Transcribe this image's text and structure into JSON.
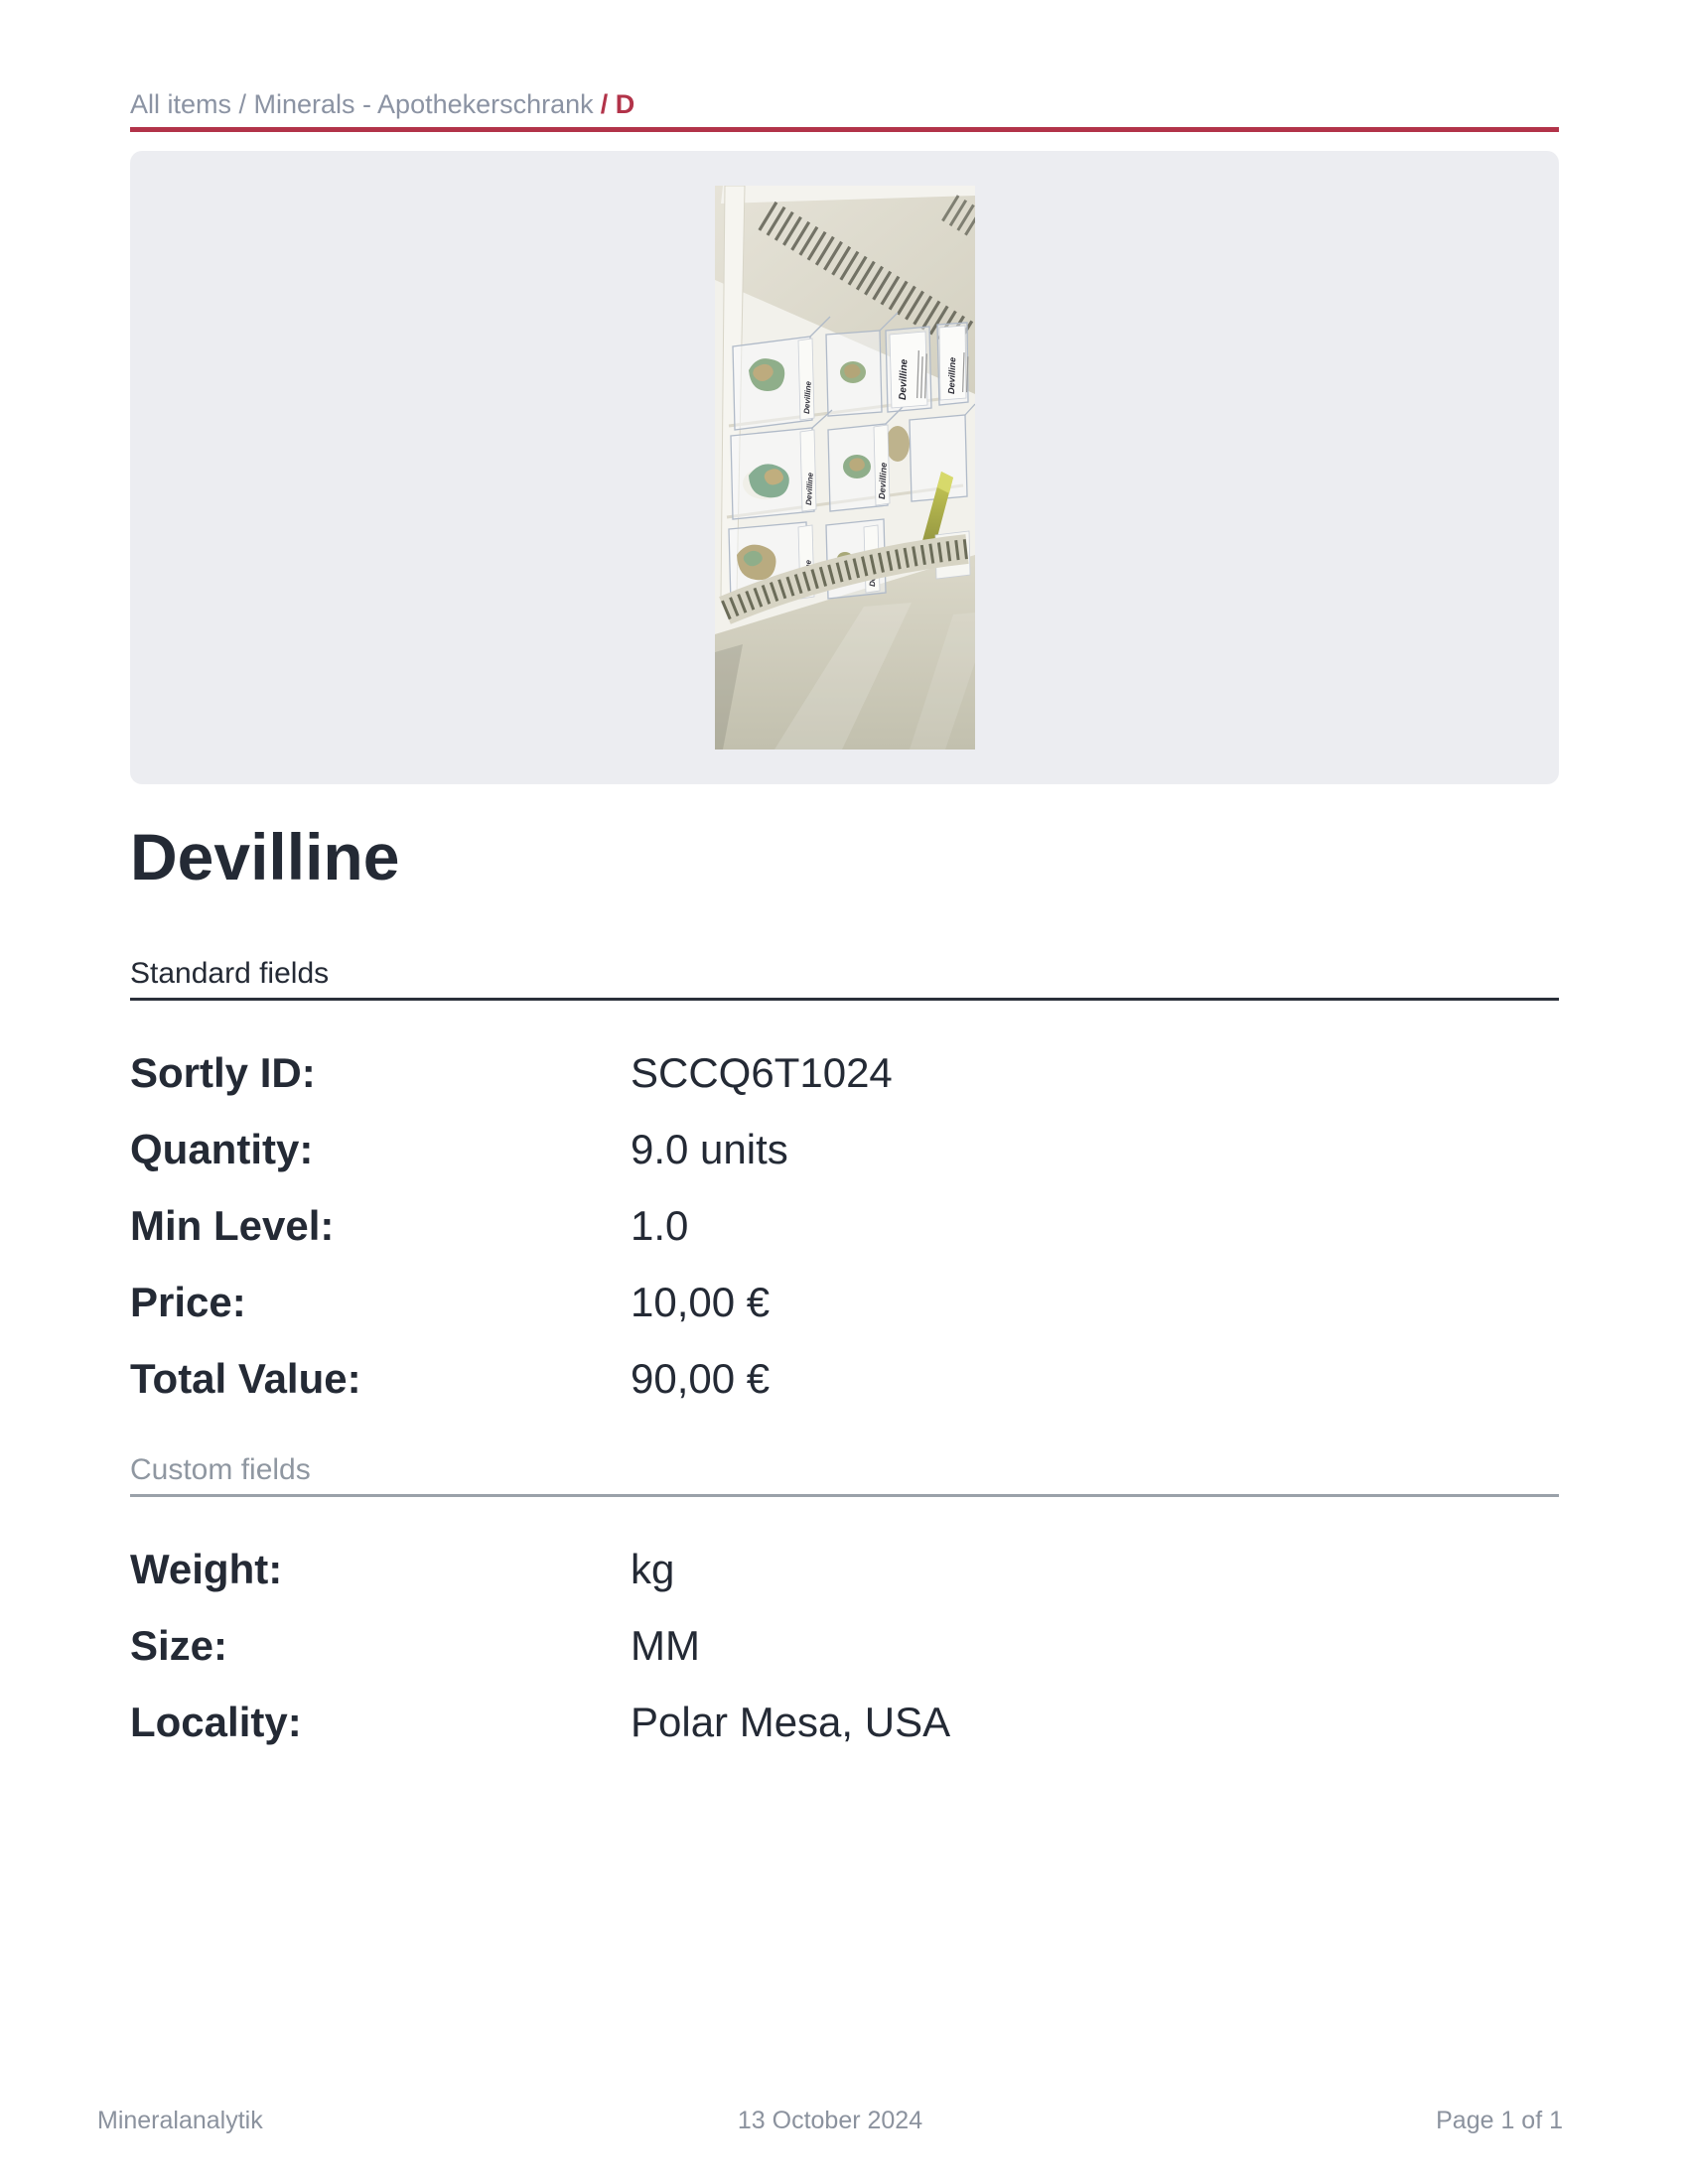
{
  "breadcrumb": {
    "path": "All items / Minerals - Apothekerschrank",
    "current": "/ D"
  },
  "photo": {
    "label_text": "Devilline"
  },
  "title": "Devilline",
  "standard_fields": {
    "heading": "Standard fields",
    "rows": [
      {
        "label": "Sortly ID:",
        "value": "SCCQ6T1024"
      },
      {
        "label": "Quantity:",
        "value": "9.0 units"
      },
      {
        "label": "Min Level:",
        "value": "1.0"
      },
      {
        "label": "Price:",
        "value": "10,00 €"
      },
      {
        "label": "Total Value:",
        "value": "90,00 €"
      }
    ]
  },
  "custom_fields": {
    "heading": "Custom fields",
    "rows": [
      {
        "label": "Weight:",
        "value": "kg"
      },
      {
        "label": "Size:",
        "value": "MM"
      },
      {
        "label": "Locality:",
        "value": "Polar Mesa, USA"
      }
    ]
  },
  "footer": {
    "left": "Mineralanalytik",
    "center": "13 October 2024",
    "right": "Page 1 of 1"
  },
  "colors": {
    "accent_red": "#b23349",
    "text_dark": "#242a35",
    "text_gray": "#8b93a3",
    "panel_bg": "#ecedf1"
  }
}
